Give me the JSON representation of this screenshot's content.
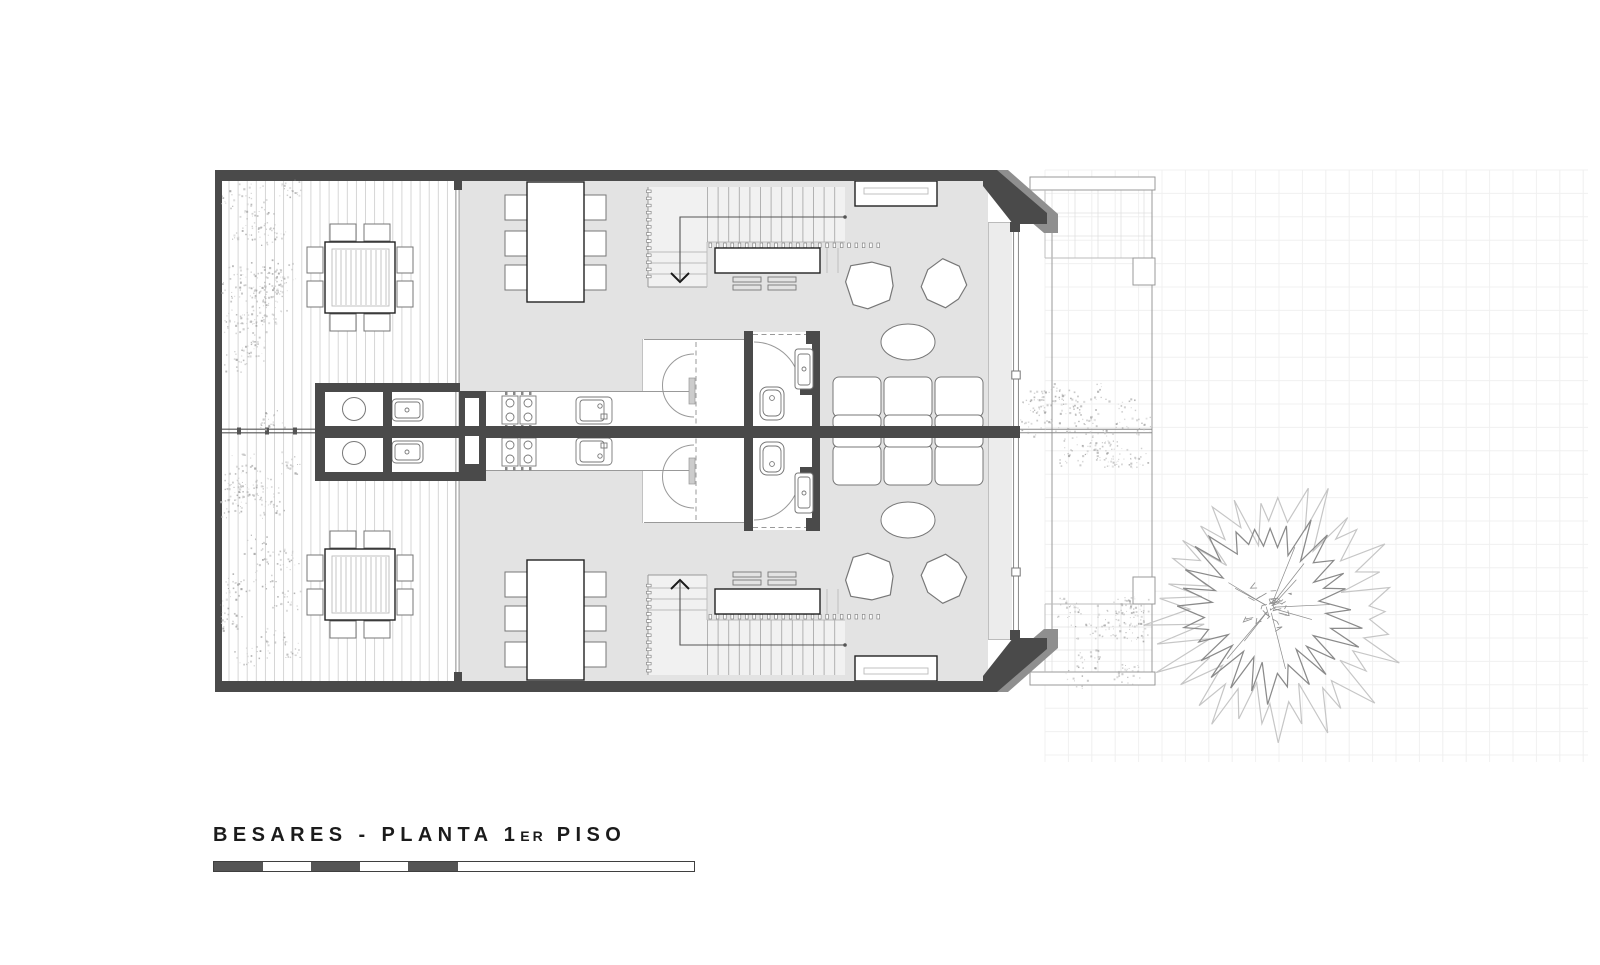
{
  "title": {
    "prefix": "BESARES - PLANTA 1",
    "ordinal": "ER",
    "rest": " PISO"
  },
  "page_background": "#ffffff",
  "colors": {
    "wall": "#4a4a4a",
    "wall_mid": "#8f8f8f",
    "floor": "#e3e3e3",
    "stripe": "#ececec",
    "stair_bg": "#f1f1f1",
    "furniture": "#777777",
    "ink": "#222222",
    "line": "#999999",
    "line_light": "#bbbbbb",
    "deck_line": "#d2d2d2",
    "grid_faint": "#f0f0f0",
    "grid_cell": "#e1e1e1",
    "glass": "#7d7d7d",
    "veg": "#a8a8a8",
    "veg_light": "#c6c6c6",
    "tree_outer": "#c6c6c6",
    "tree_inner": "#8a8a8a",
    "scale_dark": "#555555",
    "walkline": "#555555",
    "thin_wall": "#8a8a8a"
  },
  "scale_bar": {
    "segments": [
      {
        "w": 49,
        "fill": "dark"
      },
      {
        "w": 48,
        "fill": "light"
      },
      {
        "w": 49,
        "fill": "dark"
      },
      {
        "w": 48,
        "fill": "light"
      },
      {
        "w": 50,
        "fill": "dark"
      },
      {
        "w": 236,
        "fill": "light"
      }
    ]
  },
  "plan": {
    "drawing_type": "first floor plan, mirrored duplex",
    "units": [
      {
        "id": "A",
        "position": "upper"
      },
      {
        "id": "B",
        "position": "lower",
        "mirror_of": "A"
      }
    ],
    "rooms_per_unit": [
      {
        "name": "deck-terrace",
        "furniture": [
          "square-dining-table",
          "8 chairs",
          "outdoor-counter-basin",
          "outdoor-counter-sink",
          "planting-bed"
        ]
      },
      {
        "name": "kitchen-dining",
        "furniture": [
          "dining-table",
          "6 chairs",
          "cooktop-4-burners",
          "kitchen-sink",
          "curved-pivot-door"
        ]
      },
      {
        "name": "stair-hall",
        "furniture": [
          "staircase",
          "desk",
          "2 stools",
          "wardrobe-dashed"
        ]
      },
      {
        "name": "bathroom",
        "furniture": [
          "toilet",
          "washbasin",
          "swing-door"
        ]
      },
      {
        "name": "living-room",
        "furniture": [
          "sofa-3-seat",
          "2 armchairs",
          "oval-coffee-table",
          "wall-heater"
        ]
      },
      {
        "name": "balcony-gallery",
        "furniture": []
      }
    ],
    "site_elements": [
      "paved-patio-grid",
      "garden-steps",
      "tree",
      "vegetation-beds",
      "party-wall-fence"
    ]
  },
  "procedural": {
    "seed": 20240613,
    "mirror_y": 862,
    "planks": {
      "x0": 229,
      "x1": 452,
      "step": 9.1,
      "y0": 181,
      "y1": 681
    },
    "slats": {
      "x0": 336,
      "x1": 386,
      "step": 5,
      "y0": 250,
      "y1": 305
    },
    "treads": {
      "x0": 707.5,
      "x1": 845,
      "step": 10.6,
      "y0": 187,
      "y1": 242
    },
    "balusters": {
      "row": {
        "x0": 709,
        "x1": 877,
        "step": 7.3,
        "y": 243,
        "w": 2.6,
        "h": 4.6
      },
      "col": {
        "x": 646.5,
        "y0": 190,
        "y1": 282,
        "step": 7.1,
        "w": 4.6,
        "h": 2.6
      }
    },
    "grids": [
      {
        "x0": 1045,
        "y0": 170,
        "x1": 1588,
        "y1": 762,
        "step": 23.4,
        "color_key": "grid_faint",
        "width": 1
      },
      {
        "x0": 1052,
        "y0": 190,
        "x1": 1152,
        "y1": 258,
        "step": 23,
        "color_key": "grid_cell",
        "width": 0.8
      },
      {
        "x0": 1052,
        "y0": 604,
        "x1": 1152,
        "y1": 672,
        "step": 23,
        "color_key": "grid_cell",
        "width": 0.8
      }
    ],
    "vegetation": [
      {
        "x": 224,
        "y": 183,
        "w": 72,
        "h": 245,
        "clumps": 34
      },
      {
        "x": 224,
        "y": 455,
        "w": 72,
        "h": 215,
        "clumps": 30
      },
      {
        "x": 1024,
        "y": 386,
        "w": 124,
        "h": 80,
        "clumps": 26
      },
      {
        "x": 1058,
        "y": 600,
        "w": 86,
        "h": 84,
        "clumps": 18
      }
    ],
    "armchairs": [
      {
        "cx": 869,
        "cy": 284,
        "r": 26
      },
      {
        "cx": 943,
        "cy": 284,
        "r": 25
      }
    ],
    "tree": {
      "cx": 1270,
      "cy": 608,
      "outer_r": 132,
      "inner_r": 96,
      "outer_points": 66,
      "inner_points": 56,
      "scribbles": 26,
      "twigs": 10
    }
  }
}
